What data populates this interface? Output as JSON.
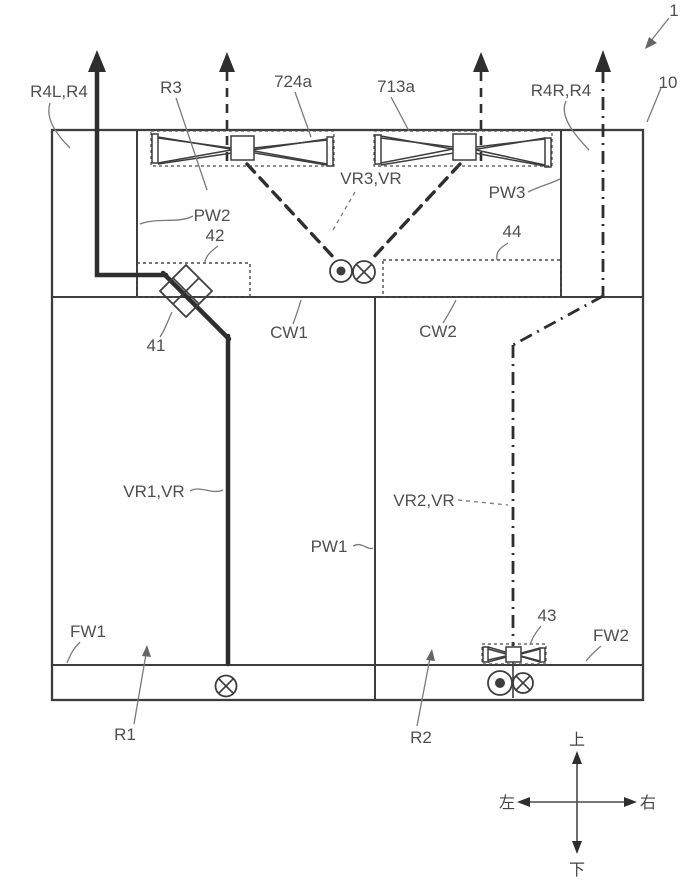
{
  "figure": {
    "type": "patent-diagram",
    "description": "Vehicle body air-flow schematic with ducts, fans, dampers and walls"
  },
  "labels": {
    "ref1": "1",
    "ref10": "10",
    "r4l": "R4L,R4",
    "r3": "R3",
    "p724a": "724a",
    "p713a": "713a",
    "r4r": "R4R,R4",
    "vr3": "VR3,VR",
    "pw2": "PW2",
    "pw3": "PW3",
    "ref42": "42",
    "ref44": "44",
    "ref41": "41",
    "cw1": "CW1",
    "cw2": "CW2",
    "vr1": "VR1,VR",
    "vr2": "VR2,VR",
    "pw1": "PW1",
    "fw1": "FW1",
    "fw2": "FW2",
    "ref43": "43",
    "r1": "R1",
    "r2": "R2"
  },
  "compass": {
    "up": "上",
    "down": "下",
    "left": "左",
    "right": "右"
  },
  "colors": {
    "background": "#ffffff",
    "line": "#3d3d3d",
    "flow_line": "#2e2e2e",
    "leader": "#7a7a7a",
    "text": "#4f4f4f"
  }
}
